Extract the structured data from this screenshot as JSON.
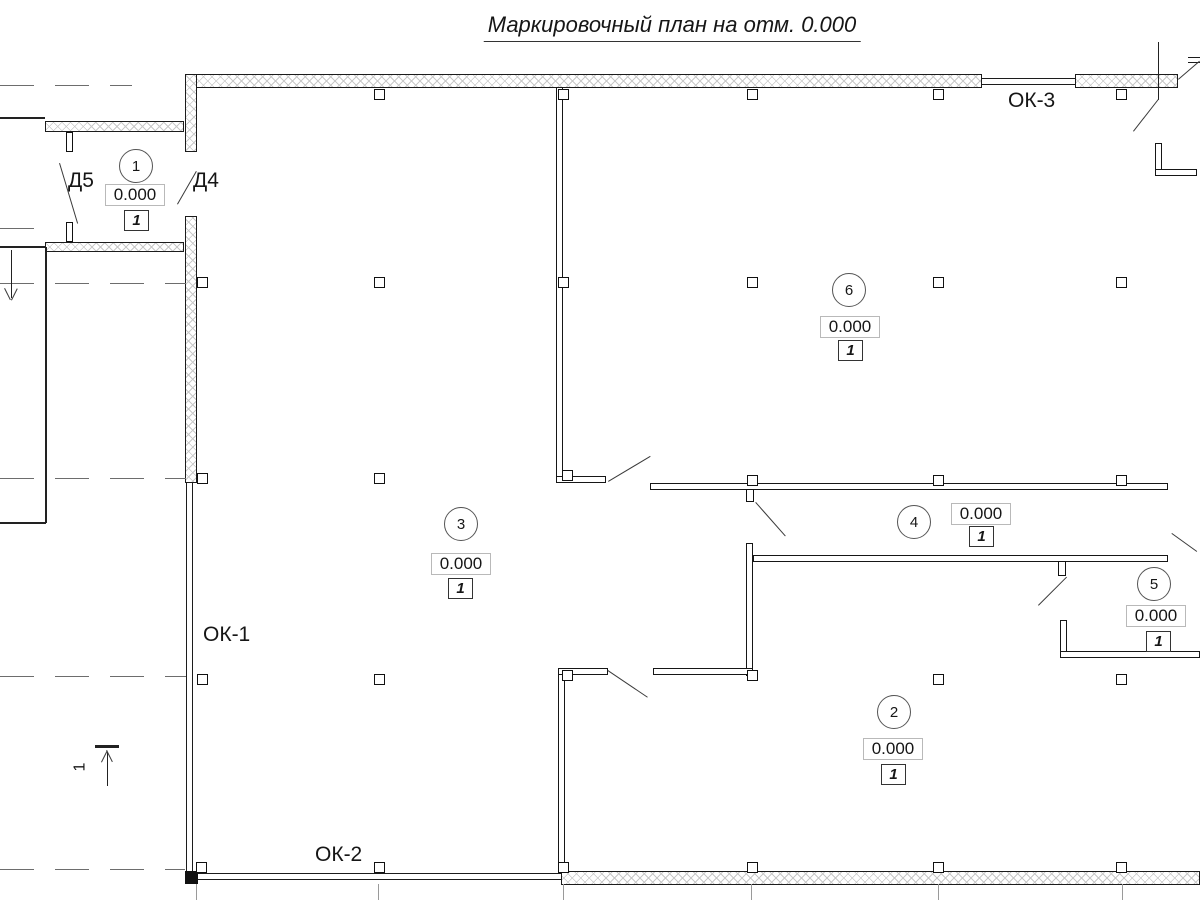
{
  "title": "Маркировочный план на отм. 0.000",
  "doors": {
    "d5": "Д5",
    "d4": "Д4"
  },
  "windows": {
    "ok1": "ОК-1",
    "ok2": "ОК-2",
    "ok3": "ОК-3"
  },
  "section": {
    "number": "1"
  },
  "rooms": [
    {
      "number": "1",
      "elevation": "0.000",
      "floor_type": "1"
    },
    {
      "number": "2",
      "elevation": "0.000",
      "floor_type": "1"
    },
    {
      "number": "3",
      "elevation": "0.000",
      "floor_type": "1"
    },
    {
      "number": "4",
      "elevation": "0.000",
      "floor_type": "1"
    },
    {
      "number": "5",
      "elevation": "0.000",
      "floor_type": "1"
    },
    {
      "number": "6",
      "elevation": "0.000",
      "floor_type": "1"
    }
  ],
  "colors": {
    "line": "#1c1c1c",
    "hatch": "#c9c9c9",
    "grid": "#9a9a9a"
  }
}
